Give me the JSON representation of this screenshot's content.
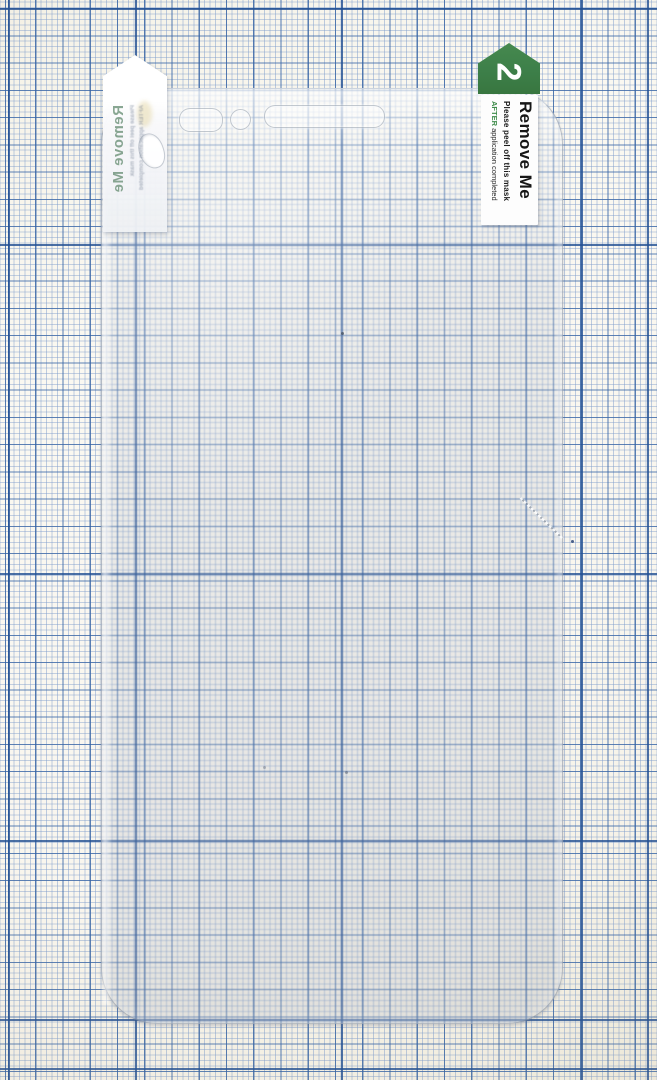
{
  "tabs": {
    "white_tab": {
      "title_mirrored": "Remove Me",
      "small_line1": "Please peel off this mask",
      "small_line2": "AFTER application completed"
    },
    "green_tab": {
      "step_number": "2",
      "title": "Remove Me",
      "instruction": "Please peel off this mask",
      "instruction_emphasis": "AFTER",
      "instruction_rest": " application completed"
    }
  },
  "colors": {
    "paper": "#f8f5ec",
    "grid_fine": "#8a9ecc",
    "grid_medium": "#3462a3",
    "grid_major": "#235094",
    "tab_green": "#3d7f49",
    "after_green": "#3f8c4b",
    "label_text": "#161616",
    "mirrored_text_green": "#688e74",
    "protector_tint": "rgba(160,168,185,0.21)"
  }
}
